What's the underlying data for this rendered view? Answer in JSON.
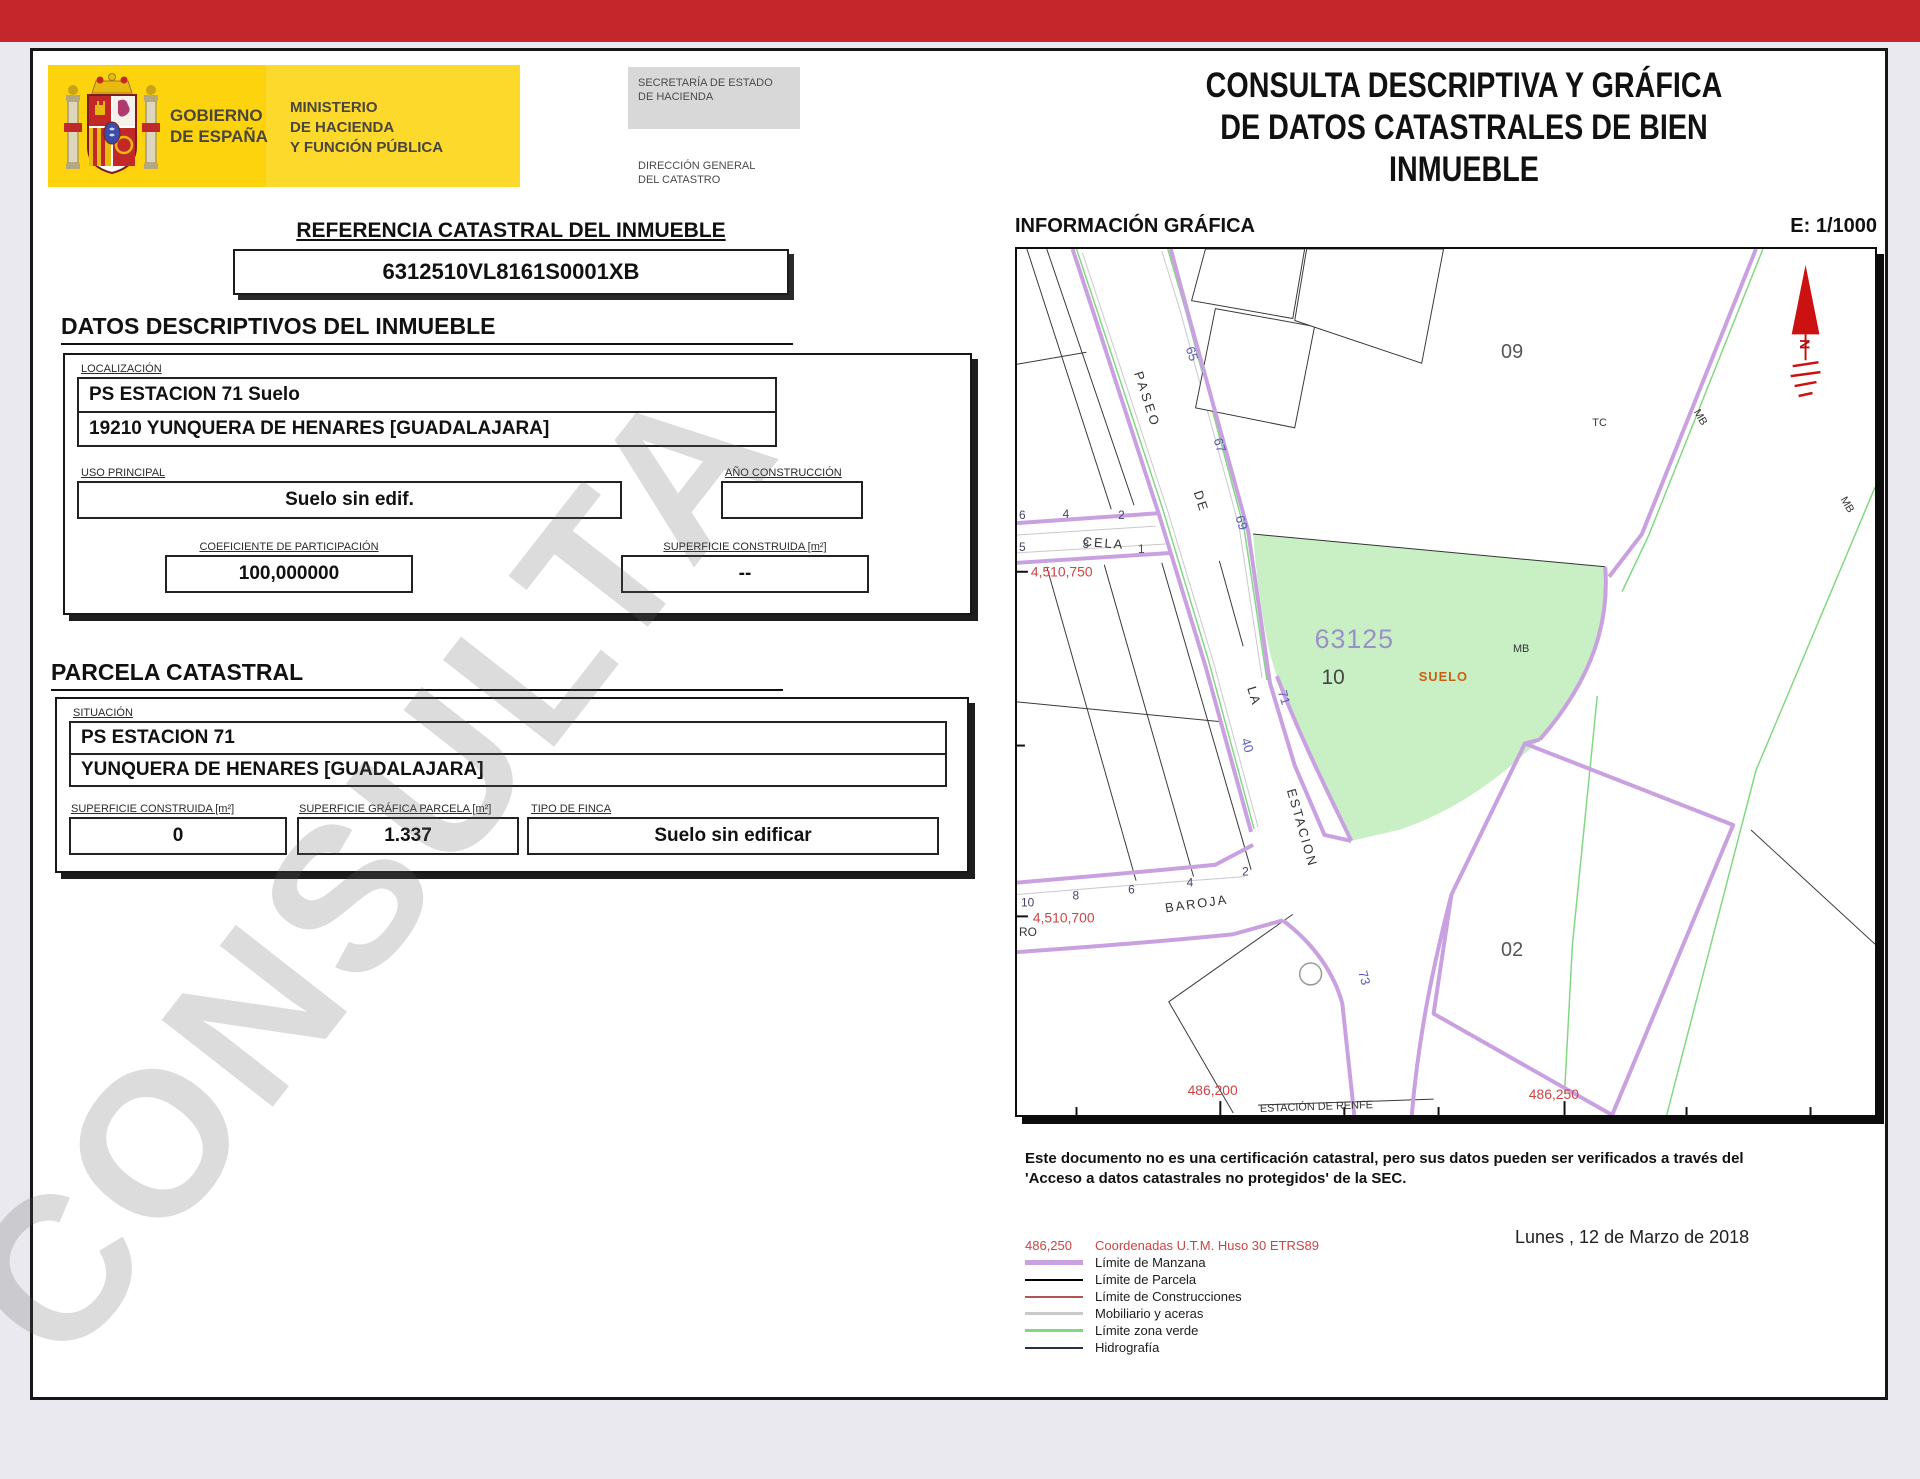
{
  "header": {
    "gobierno1": "GOBIERNO",
    "gobierno2": "DE ESPAÑA",
    "ministerio1": "MINISTERIO",
    "ministerio2": "DE HACIENDA",
    "ministerio3": "Y FUNCIÓN PÚBLICA",
    "secretaria1": "SECRETARÍA DE ESTADO",
    "secretaria2": "DE HACIENDA",
    "direccion1": "DIRECCIÓN GENERAL",
    "direccion2": "DEL CATASTRO",
    "title1": "CONSULTA DESCRIPTIVA Y GRÁFICA",
    "title2": "DE DATOS CATASTRALES DE BIEN INMUEBLE"
  },
  "reference": {
    "heading": "REFERENCIA CATASTRAL DEL INMUEBLE",
    "value": "6312510VL8161S0001XB"
  },
  "datos": {
    "heading": "DATOS DESCRIPTIVOS DEL INMUEBLE",
    "localizacion_label": "LOCALIZACIÓN",
    "localizacion_line1": "PS ESTACION 71 Suelo",
    "localizacion_line2": "19210 YUNQUERA DE HENARES [GUADALAJARA]",
    "uso_label": "USO PRINCIPAL",
    "uso_value": "Suelo sin edif.",
    "anio_label": "AÑO CONSTRUCCIÓN",
    "anio_value": "",
    "coef_label": "COEFICIENTE DE PARTICIPACIÓN",
    "coef_value": "100,000000",
    "superficie_label": "SUPERFICIE CONSTRUIDA [m²]",
    "superficie_value": "--"
  },
  "parcela": {
    "heading": "PARCELA CATASTRAL",
    "situacion_label": "SITUACIÓN",
    "situacion_line1": "PS ESTACION 71",
    "situacion_line2": "YUNQUERA DE HENARES [GUADALAJARA]",
    "sup_construida_label": "SUPERFICIE CONSTRUIDA [m²]",
    "sup_construida_value": "0",
    "sup_grafica_label": "SUPERFICIE GRÁFICA PARCELA [m²]",
    "sup_grafica_value": "1.337",
    "tipo_label": "TIPO DE FINCA",
    "tipo_value": "Suelo sin edificar"
  },
  "map": {
    "heading": "INFORMACIÓN GRÁFICA",
    "scale": "E: 1/1000",
    "labels": {
      "paseo": "PASEO",
      "de": "DE",
      "la": "LA",
      "estacion": "ESTACION",
      "cela": "CELA",
      "baroja": "BAROJA",
      "n65": "65",
      "n67": "67",
      "n69": "69",
      "n71": "71",
      "n40": "40",
      "n73": "73",
      "c6": "6",
      "c4": "4",
      "c2": "2",
      "c5": "5",
      "c3": "3",
      "c1": "1",
      "b10": "10",
      "b8": "8",
      "b6": "6",
      "b4": "4",
      "b2": "2",
      "block09": "09",
      "block02": "02",
      "block10": "10",
      "tc": "TC",
      "mb": "MB",
      "parcel": "63125",
      "suelo": "SUELO",
      "coord_left_top": "4,510,750",
      "coord_left_bottom": "4,510,700",
      "coord_bottom_left": "486,200",
      "coord_bottom_right": "486,250",
      "renfe": "ESTACIÓN DE RENFE",
      "ro": "RO",
      "north": "N"
    }
  },
  "footer": {
    "disclaimer1": "Este documento no es una certificación catastral, pero sus datos pueden ser verificados a través del",
    "disclaimer2": "'Acceso a datos catastrales no protegidos' de la SEC.",
    "coords_sample": "486,250",
    "coords_label": "Coordenadas U.T.M. Huso 30 ETRS89",
    "legend": [
      {
        "label": "Límite de Manzana",
        "color": "#c9a0e0"
      },
      {
        "label": "Límite de Parcela",
        "color": "#000000"
      },
      {
        "label": "Límite de Construcciones",
        "color": "#b05555"
      },
      {
        "label": "Mobiliario y aceras",
        "color": "#c9c9c9"
      },
      {
        "label": "Límite zona verde",
        "color": "#82d882"
      },
      {
        "label": "Hidrografía",
        "color": "#273049"
      }
    ],
    "date": "Lunes , 12 de Marzo de 2018"
  },
  "watermark": "CONSULTA",
  "colors": {
    "accent_red": "#c5262b",
    "brand_yellow": "#fcd30c",
    "manzana_purple": "#c9a0e0",
    "zona_verde_green": "#82d882",
    "parcel_green_fill": "#c9f0c5",
    "coord_red": "#cc4444",
    "street_number_blue": "#5b5bb5",
    "suelo_orange": "#c95f11"
  }
}
